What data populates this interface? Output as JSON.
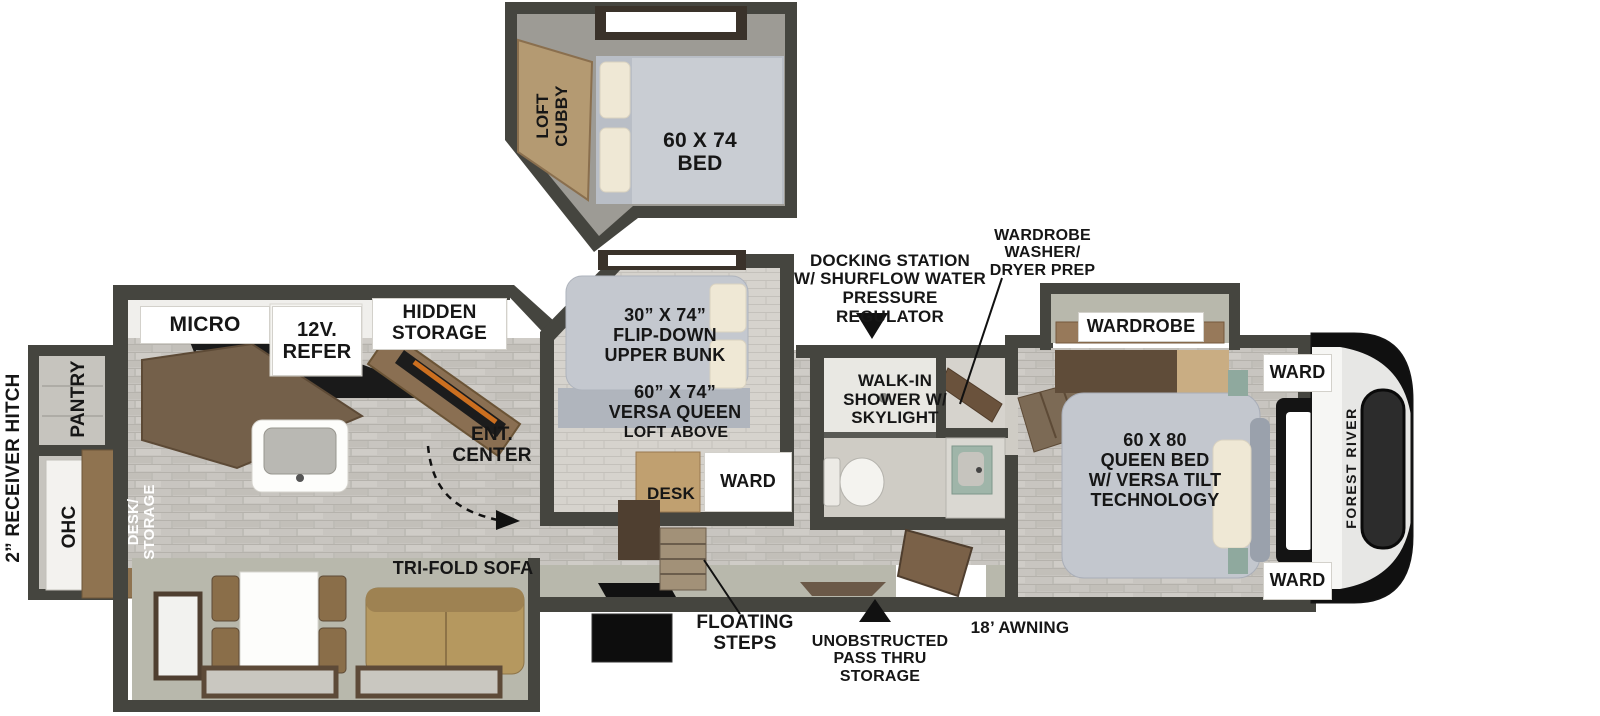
{
  "floorplan": {
    "brand": "FOREST RIVER",
    "type_note": "fifth wheel travel trailer floor plan",
    "colors": {
      "wall": "#45453f",
      "floor_tile": "#c8c5c0",
      "slide_floor": "#b8b8ac",
      "wood": "#8a6e49",
      "wood_dark": "#5d4a36",
      "mattress": "#c3c7ce",
      "cream_pillow": "#efe8d5",
      "flame_accent": "#e07820",
      "teal_accent": "#8fa99e",
      "label_bg": "#ffffff",
      "text": "#161616"
    },
    "exterior": {
      "receiver_hitch": "2” RECEIVER HITCH",
      "awning": "18’ AWNING",
      "pass_thru": "UNOBSTRUCTED\nPASS THRU\nSTORAGE",
      "docking_station": "DOCKING STATION\nW/ SHURFLOW WATER\nPRESSURE REGULATOR",
      "brand_vertical": "FOREST RIVER"
    },
    "loft": {
      "cubby": "LOFT\nCUBBY",
      "bed": "60 X 74\nBED"
    },
    "kitchen": {
      "micro": "MICRO",
      "refer": "12V.\nREFER",
      "hidden_storage": "HIDDEN\nSTORAGE",
      "pantry": "PANTRY",
      "ohc": "OHC",
      "desk_storage": "DESK/\nSTORAGE",
      "ent_center": "ENT.\nCENTER"
    },
    "bunk_room": {
      "upper_bunk": "30” X 74”\nFLIP-DOWN\nUPPER BUNK",
      "versa_queen": "60” X 74”\nVERSA QUEEN",
      "loft_above": "LOFT ABOVE",
      "desk": "DESK",
      "ward": "WARD"
    },
    "bathroom": {
      "shower": "WALK-IN\nSHOWER W/\nSKYLIGHT",
      "wd_prep": "WARDROBE\nWASHER/\nDRYER PREP"
    },
    "bedroom": {
      "wardrobe": "WARDROBE",
      "ward_top": "WARD",
      "ward_bottom": "WARD",
      "queen_bed": "60 X 80\nQUEEN BED\nW/ VERSA TILT\nTECHNOLOGY"
    },
    "living": {
      "sofa": "TRI-FOLD SOFA",
      "floating_steps": "FLOATING\nSTEPS"
    }
  }
}
